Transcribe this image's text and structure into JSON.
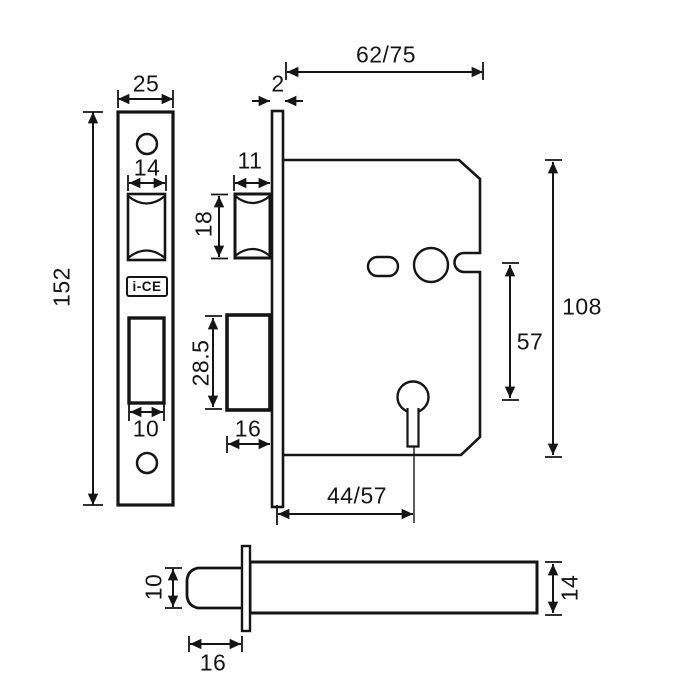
{
  "page": {
    "background": "#ffffff",
    "line_color": "#151515",
    "description": "Mortise lock technical dimension drawing"
  },
  "logo": {
    "text": "i-CE"
  },
  "labels": {
    "case_depth": "62/75",
    "faceplate_side_thickness": "2",
    "faceplate_width": "25",
    "faceplate_height": "152",
    "latch_cutout_width": "14",
    "latch_width": "11",
    "latch_height": "18",
    "deadbolt_height": "28.5",
    "deadbolt_cutout_width": "10",
    "deadbolt_width": "16",
    "case_height": "108",
    "spindle_to_keyhole": "57",
    "backset": "44/57",
    "bolt_diameter": "10",
    "bolt_throw": "16",
    "case_thickness": "14"
  }
}
